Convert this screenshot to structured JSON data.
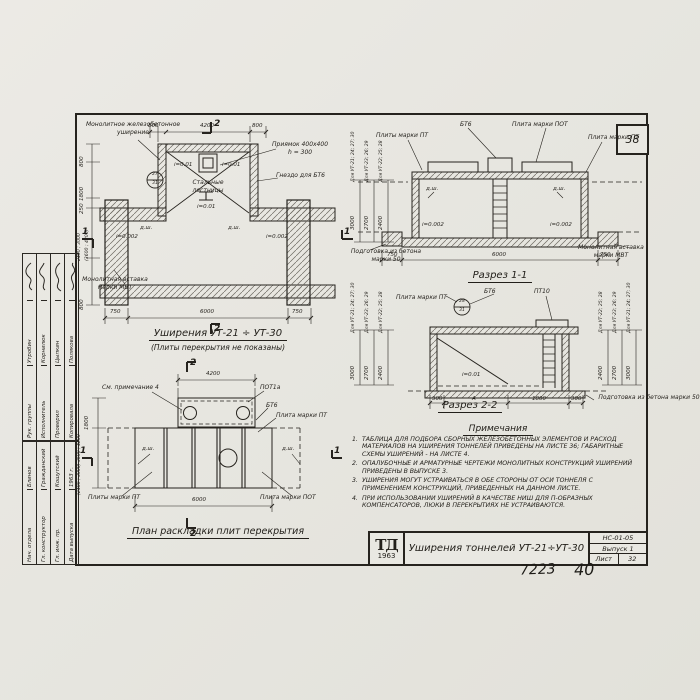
{
  "sheet": {
    "page_number": "38",
    "handwritten_left": "7223",
    "handwritten_right": "40"
  },
  "title_block": {
    "logo_top": "ТД",
    "logo_year": "1963",
    "title": "Уширения тоннелей УТ-21÷УТ-30",
    "doc_code": "НС-01-05",
    "issue": "Выпуск 1",
    "sheet_word": "Лист",
    "sheet_number": "32"
  },
  "signature_block": {
    "upper_rows": [
      {
        "role": "Рук. группы",
        "name": "Утробин"
      },
      {
        "role": "Исполнитель",
        "name": "Корнилюк"
      },
      {
        "role": "Проверил",
        "name": "Цыпкин"
      },
      {
        "role": "Копировала",
        "name": "Полякова"
      }
    ],
    "lower_rows": [
      {
        "role": "Нач. отдела",
        "name": "Блинов"
      },
      {
        "role": "Гл. конструктор",
        "name": "Гражданский"
      },
      {
        "role": "Гл. инж. пр.",
        "name": "Кошутский"
      },
      {
        "role": "Дата выпуска",
        "name": "1963 г."
      }
    ]
  },
  "plan_top": {
    "title": "Уширения УТ-21 ÷ УТ-30",
    "subtitle": "(Плиты перекрытия не показаны)",
    "labels": {
      "widening": "Монолитное железобетонное уширение",
      "pit": "Приямок 400х400",
      "pit_h": "h = 300",
      "socket": "Гнездо для БТ6",
      "stairs": "Стальные лестницы",
      "insert": "Монолитная вставка марки МВТ",
      "node_top": "27",
      "node_bottom": "31"
    },
    "dims": {
      "top": [
        "800",
        "4200",
        "800"
      ],
      "bottom": [
        "750",
        "6000",
        "750"
      ],
      "left": [
        "800",
        "1800",
        "250",
        "2400 ; 3000",
        "(3600 ; 4200)",
        "800"
      ],
      "slope_pit": "i=0.01",
      "slope_side": "i=0.002",
      "joint": "д.ш."
    },
    "marks": {
      "v": "2",
      "h": "1"
    }
  },
  "section1": {
    "title": "Разрез 1-1",
    "labels": {
      "bt6": "БТ6",
      "plate_pot": "Плита марки ПОТ",
      "plates_pt": "Плиты марки ПТ",
      "plate_pt": "Плита марки ПТ",
      "prep": "Подготовка из бетона марки 50",
      "insert": "Монолитная вставка марки МВТ",
      "joint": "д.ш.",
      "slope": "i=0.002"
    },
    "height_cols": [
      {
        "label": "Для УТ-21; 24; 27; 30",
        "value": "3000"
      },
      {
        "label": "Для УТ-23; 26; 29",
        "value": "2700"
      },
      {
        "label": "Для УТ-22; 25; 28",
        "value": "2400"
      }
    ],
    "dims_bottom": [
      "750",
      "6000",
      "750"
    ]
  },
  "section2": {
    "title": "Разрез 2-2",
    "labels": {
      "plate_pt": "Плита марки ПТ",
      "bt6": "БТ6",
      "pt10": "ПТ10",
      "slope": "i=0.01",
      "prep": "Подготовка из бетона марки 50",
      "node_top": "28",
      "node_bottom": "31"
    },
    "height_cols_left": [
      {
        "label": "Для УТ-21; 24; 27; 30",
        "value": "3000"
      },
      {
        "label": "Для УТ-23; 26; 29",
        "value": "2700"
      },
      {
        "label": "Для УТ-22; 25; 28",
        "value": "2400"
      }
    ],
    "height_cols_right": [
      {
        "label": "Для УТ-22; 25; 28",
        "value": "2400"
      },
      {
        "label": "Для УТ-23; 26; 29",
        "value": "2700"
      },
      {
        "label": "Для УТ-21; 24; 27; 30",
        "value": "3000"
      }
    ],
    "dims_bottom": [
      "300",
      "А",
      "1800",
      "300"
    ]
  },
  "plan_bottom": {
    "title": "План раскладки плит перекрытия",
    "labels": {
      "see_note": "См. примечание 4",
      "pot1a": "ПОТ1а",
      "bt6": "БТ6",
      "plate_pt": "Плита марки ПТ",
      "plates_pt": "Плиты марки ПТ",
      "plate_pot": "Плита марки ПОТ",
      "joint": "д.ш."
    },
    "dims": {
      "top": "4200",
      "left_upper": "1800",
      "left_lower": "(2400 ; 3000) 3600 ; 4200",
      "bottom": "6000"
    },
    "marks": {
      "v": "2",
      "h": "1"
    }
  },
  "notes": {
    "header": "Примечания",
    "items": [
      {
        "num": "1.",
        "text": "Таблица для подбора сборных железобетонных элементов и расход материалов на уширения тоннелей приведены на листе 36; габаритные схемы уширений - на листе 4."
      },
      {
        "num": "2.",
        "text": "Опалубочные и арматурные чертежи монолитных конструкций уширений приведены в выпуске 3."
      },
      {
        "num": "3.",
        "text": "Уширения могут устраиваться в обе стороны от оси тоннеля с применением конструкций, приведенных на данном листе."
      },
      {
        "num": "4.",
        "text": "При использовании уширений в качестве ниш для П-образных компенсаторов, люки в перекрытиях не устраиваются."
      }
    ]
  }
}
